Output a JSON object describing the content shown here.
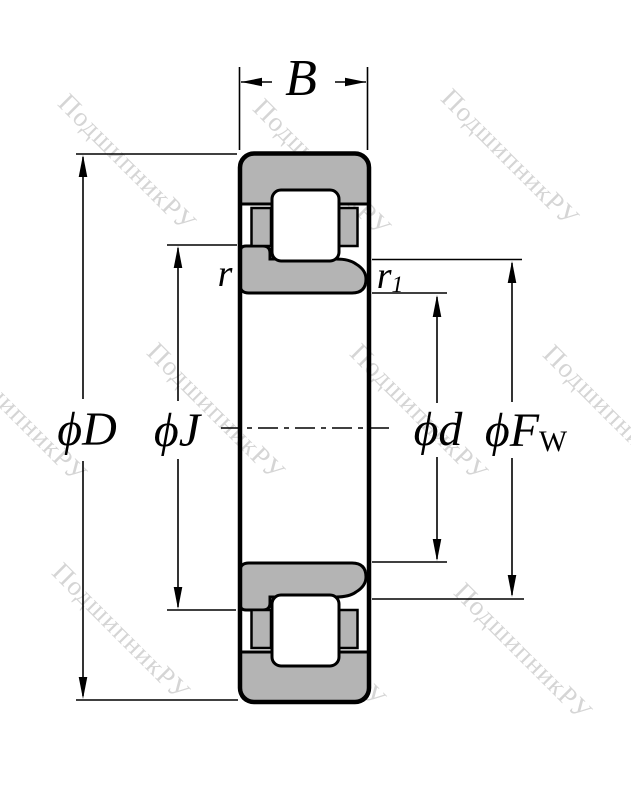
{
  "watermark": {
    "text": "ПодшипникРУ"
  },
  "labels": {
    "width": "B",
    "outer_diameter": "ϕD",
    "flange_diameter": "ϕJ",
    "bore_diameter": "ϕd",
    "raceway_diameter": {
      "main": "ϕF",
      "sub": "W"
    },
    "chamfer_outer": "r",
    "chamfer_inner": {
      "main": "r",
      "sub": "1"
    }
  },
  "colors": {
    "ring_fill": "#b4b4b4",
    "outline": "#000000",
    "watermark": "#d5d5d5",
    "background": "#ffffff"
  }
}
